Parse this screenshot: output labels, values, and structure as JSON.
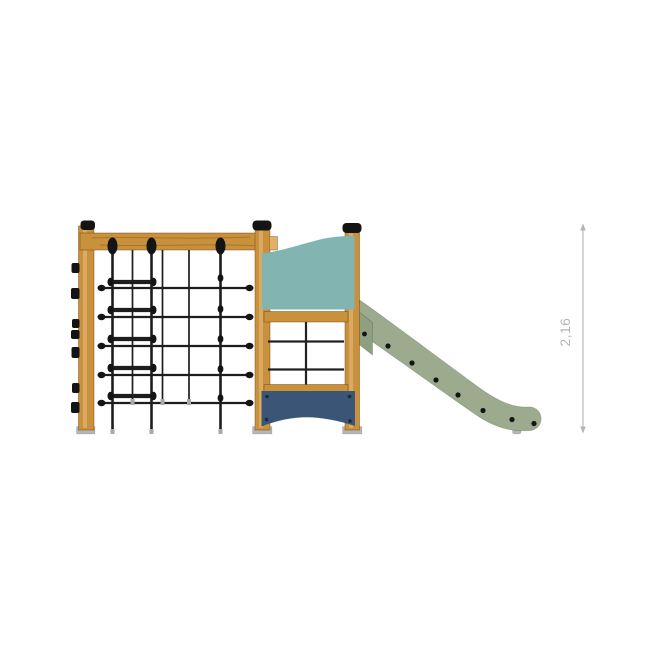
{
  "scene": {
    "subject": "wooden playground climbing frame with rope net, rope ladder, panel tower and slide",
    "background": "#ffffff",
    "dimension": {
      "label": "2,16"
    },
    "colors": {
      "wood": "#c9913c",
      "wood_light": "#e2b069",
      "rope": "#1d1d1d",
      "hardware": "#141414",
      "teal_panel": "#82b5b1",
      "navy_panel": "#3b5576",
      "slide": "#9cab8d",
      "slide_shade": "#8ea081",
      "base_plate": "#b6b6b6",
      "dimension": "#b2b5b5",
      "background": "#ffffff"
    }
  }
}
